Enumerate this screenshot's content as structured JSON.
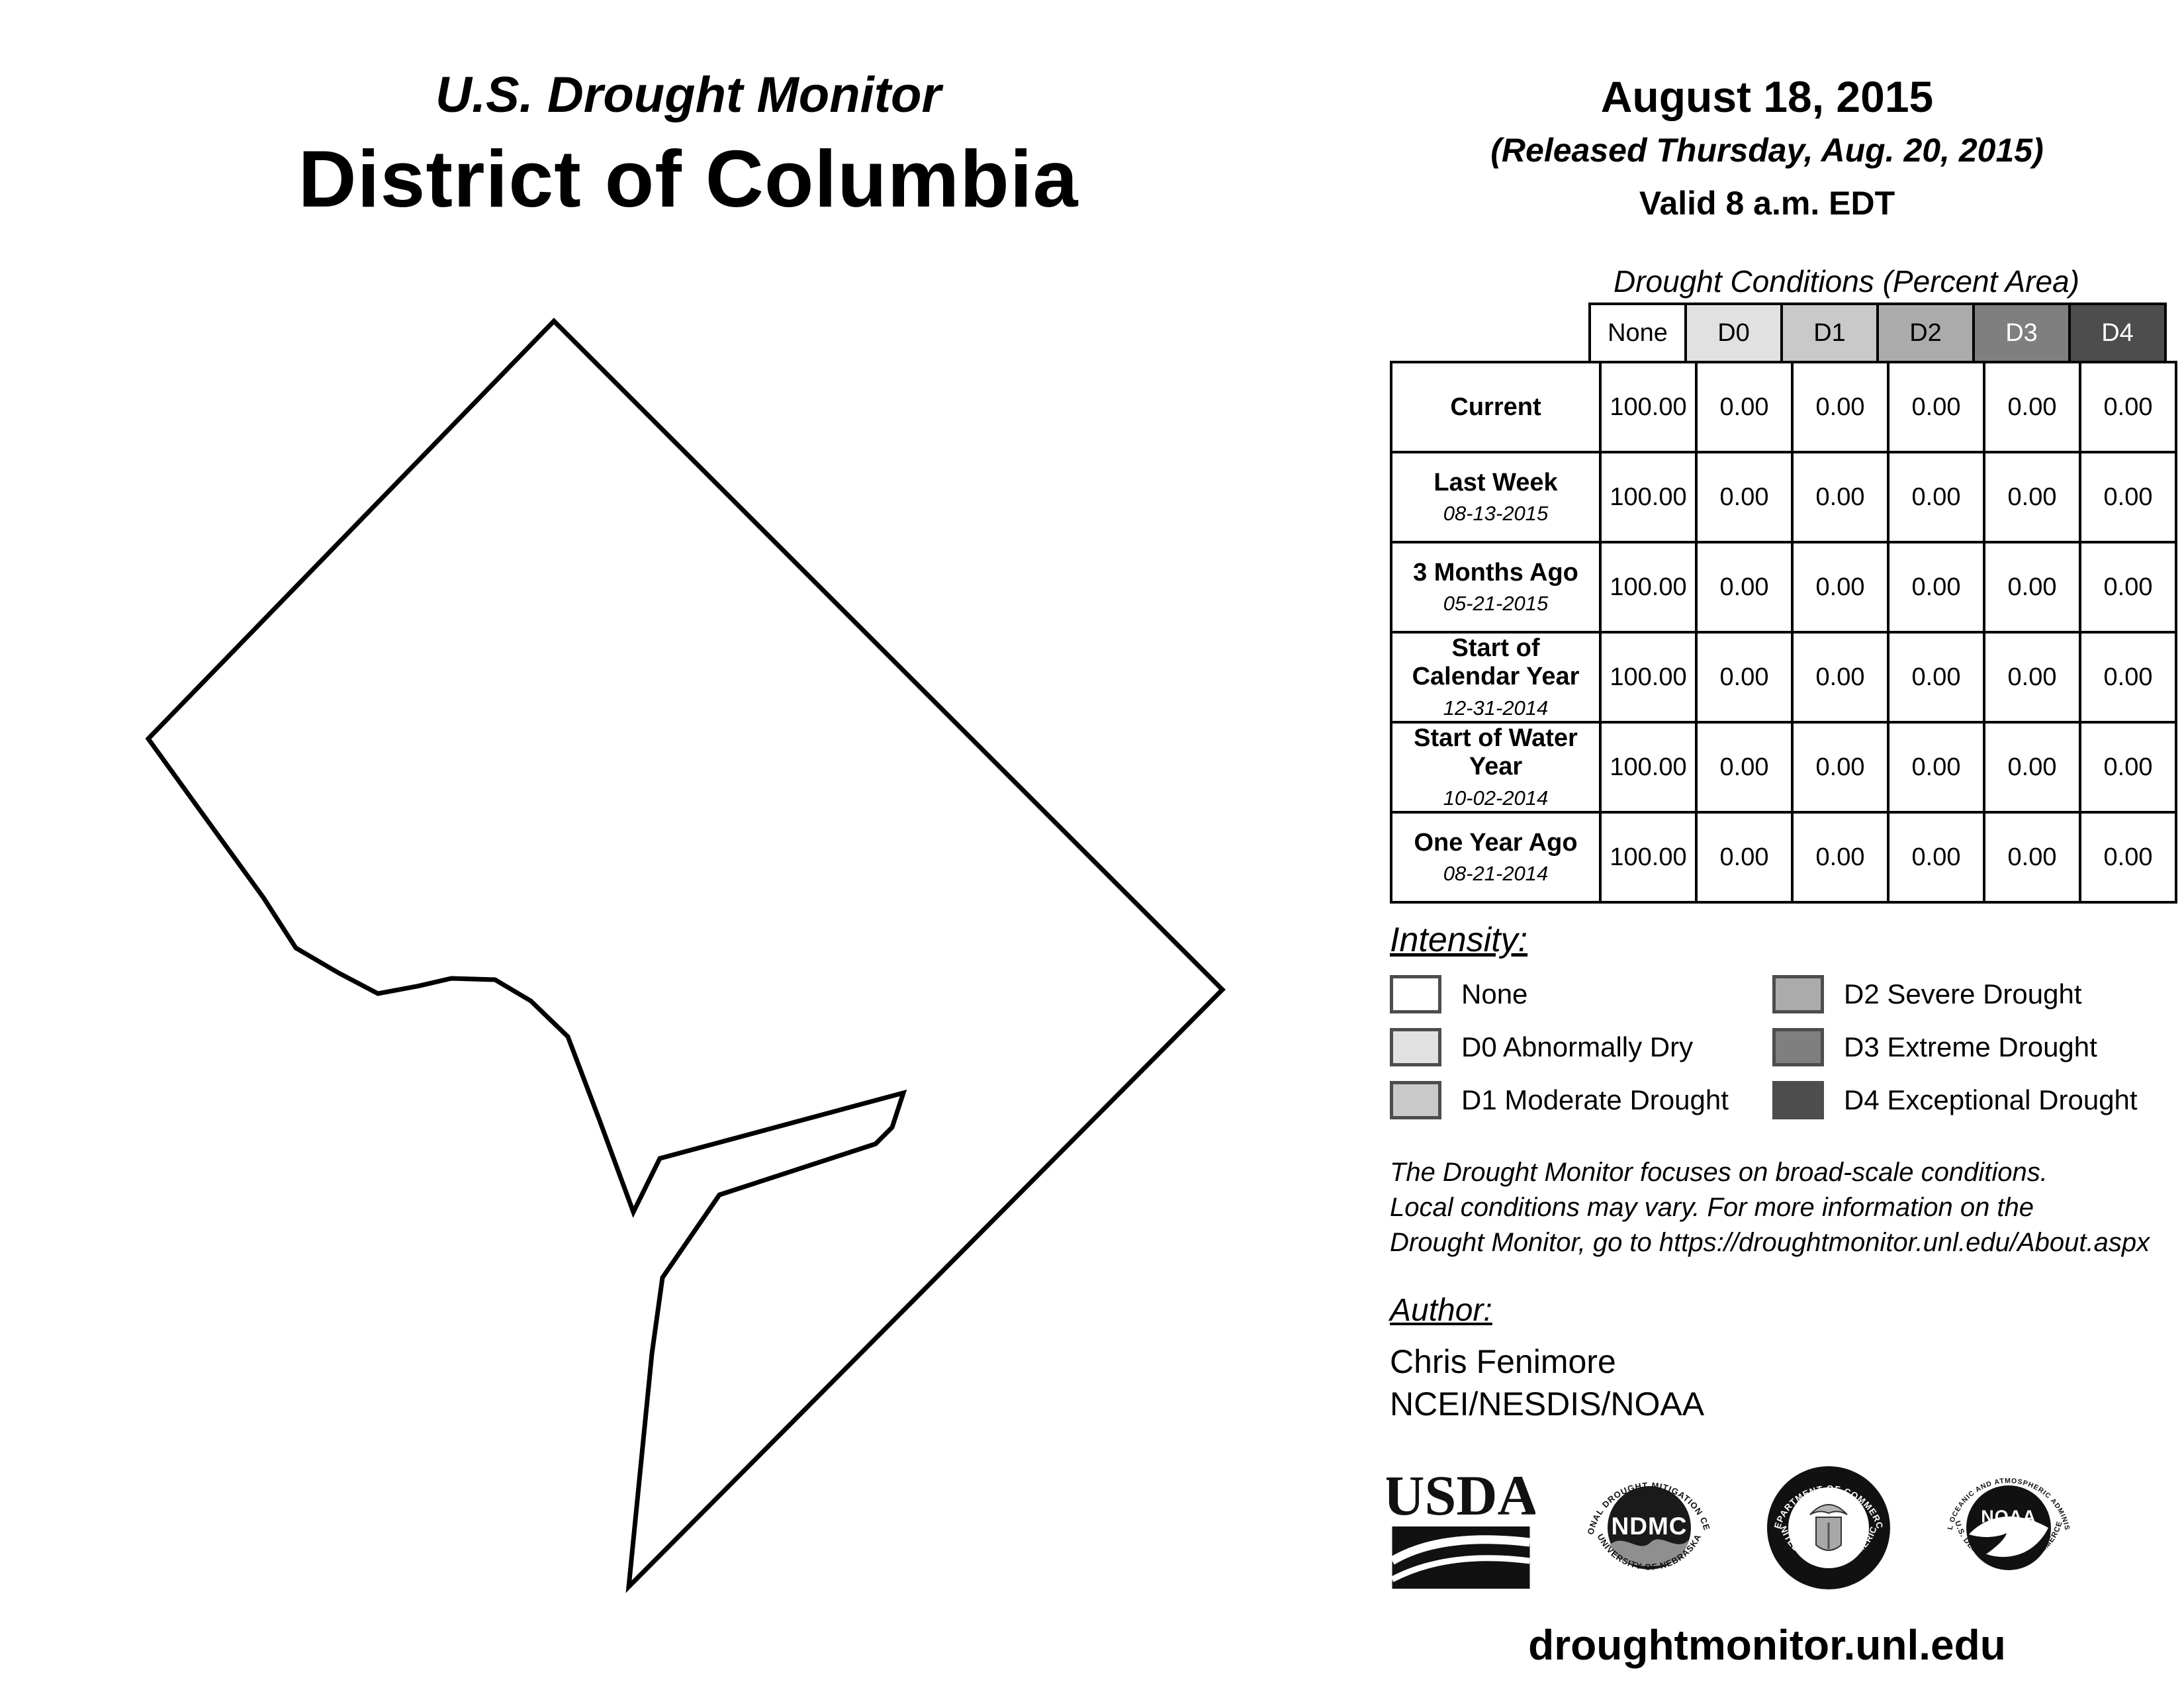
{
  "header": {
    "title": "U.S. Drought Monitor",
    "region": "District of Columbia"
  },
  "date_block": {
    "date": "August 18, 2015",
    "released": "(Released Thursday, Aug. 20, 2015)",
    "valid": "Valid 8 a.m. EDT"
  },
  "table": {
    "title": "Drought Conditions (Percent Area)",
    "columns": [
      "None",
      "D0",
      "D1",
      "D2",
      "D3",
      "D4"
    ],
    "rows": [
      {
        "label": "Current",
        "date": "",
        "values": [
          "100.00",
          "0.00",
          "0.00",
          "0.00",
          "0.00",
          "0.00"
        ]
      },
      {
        "label": "Last Week",
        "date": "08-13-2015",
        "values": [
          "100.00",
          "0.00",
          "0.00",
          "0.00",
          "0.00",
          "0.00"
        ]
      },
      {
        "label": "3 Months Ago",
        "date": "05-21-2015",
        "values": [
          "100.00",
          "0.00",
          "0.00",
          "0.00",
          "0.00",
          "0.00"
        ]
      },
      {
        "label": "Start of Calendar Year",
        "date": "12-31-2014",
        "values": [
          "100.00",
          "0.00",
          "0.00",
          "0.00",
          "0.00",
          "0.00"
        ]
      },
      {
        "label": "Start of Water Year",
        "date": "10-02-2014",
        "values": [
          "100.00",
          "0.00",
          "0.00",
          "0.00",
          "0.00",
          "0.00"
        ]
      },
      {
        "label": "One Year Ago",
        "date": "08-21-2014",
        "values": [
          "100.00",
          "0.00",
          "0.00",
          "0.00",
          "0.00",
          "0.00"
        ]
      }
    ]
  },
  "intensity": {
    "heading": "Intensity:",
    "items": [
      {
        "code": "none",
        "label": "None",
        "color": "#ffffff"
      },
      {
        "code": "d0",
        "label": "D0 Abnormally Dry",
        "color": "#e1e1e1"
      },
      {
        "code": "d1",
        "label": "D1 Moderate Drought",
        "color": "#c9c9c9"
      },
      {
        "code": "d2",
        "label": "D2 Severe Drought",
        "color": "#ababab"
      },
      {
        "code": "d3",
        "label": "D3 Extreme Drought",
        "color": "#7f7f7f"
      },
      {
        "code": "d4",
        "label": "D4 Exceptional Drought",
        "color": "#4d4d4d"
      }
    ]
  },
  "disclaimer": {
    "line1": "The Drought Monitor focuses on broad-scale conditions.",
    "line2": "Local conditions may vary. For more information on the",
    "line3": "Drought Monitor, go to https://droughtmonitor.unl.edu/About.aspx"
  },
  "author": {
    "heading": "Author:",
    "name": "Chris Fenimore",
    "org": "NCEI/NESDIS/NOAA"
  },
  "logos": {
    "usda": {
      "text": "USDA"
    },
    "ndmc": {
      "center": "NDMC",
      "top": "NATIONAL DROUGHT MITIGATION CENTER",
      "bottom": "UNIVERSITY OF NEBRASKA"
    },
    "doc": {
      "top": "DEPARTMENT OF COMMERCE",
      "bottom": "UNITED STATES OF AMERICA"
    },
    "noaa": {
      "center": "NOAA",
      "top": "NATIONAL OCEANIC AND ATMOSPHERIC ADMINISTRATION",
      "bottom": "U.S. DEPARTMENT OF COMMERCE"
    }
  },
  "footer": {
    "url": "droughtmonitor.unl.edu"
  }
}
